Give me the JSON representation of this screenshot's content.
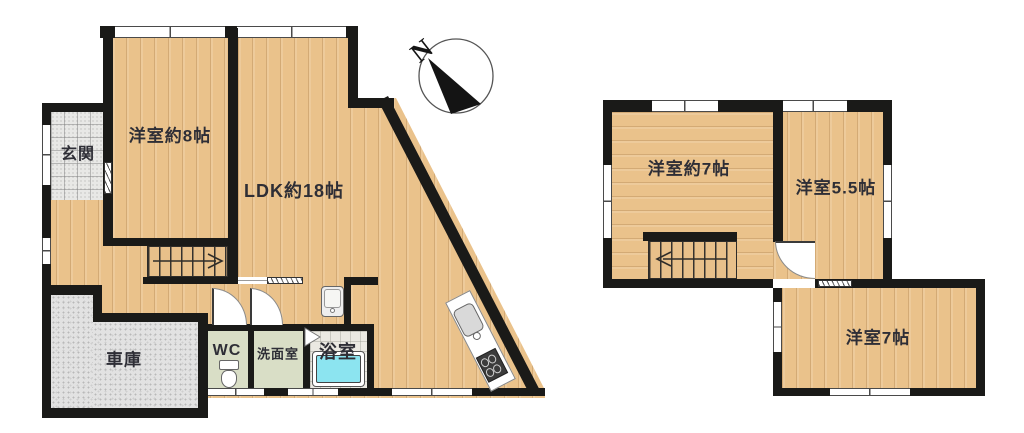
{
  "compass": {
    "label": "N"
  },
  "floor1": {
    "genkan": "玄関",
    "western8": "洋室約8帖",
    "ldk": "LDK約18帖",
    "garage": "車庫",
    "wc": "WC",
    "washroom": "洗面室",
    "bath": "浴室"
  },
  "floor2": {
    "western7a": "洋室約7帖",
    "western55": "洋室5.5帖",
    "western7b": "洋室7帖"
  },
  "colors": {
    "wall": "#1a1a18",
    "wood": "#eac28b",
    "tub": "#8ce4f0",
    "wet_floor": "#d9dec6",
    "garage_floor": "#e2e2e2"
  }
}
